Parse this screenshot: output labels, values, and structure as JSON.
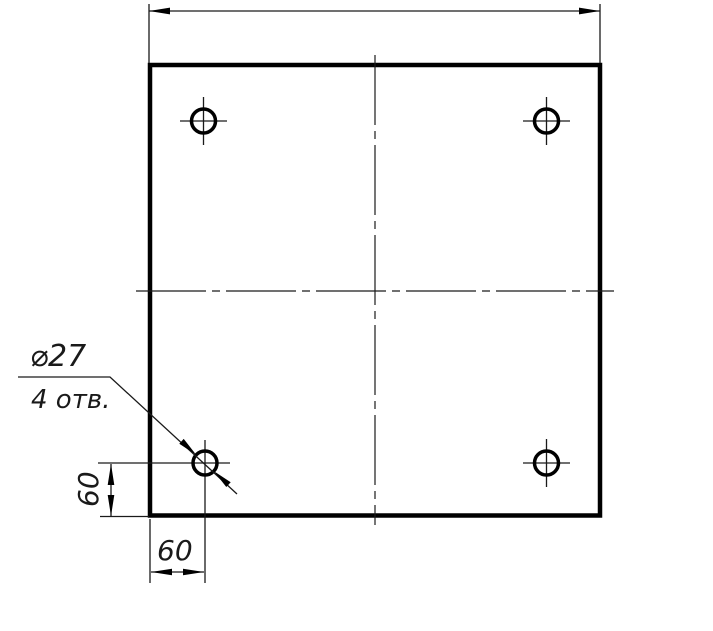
{
  "drawing": {
    "callout": {
      "diameter_label": "⌀27",
      "count_label": "4 отв."
    },
    "dimensions": {
      "left_vertical_value": "60",
      "bottom_horizontal_value": "60"
    },
    "meta": {
      "hole_count": 4,
      "hole_diameter": 27,
      "hole_offset_from_edges": 60,
      "line_color": "#000000",
      "background_color": "#ffffff"
    }
  }
}
